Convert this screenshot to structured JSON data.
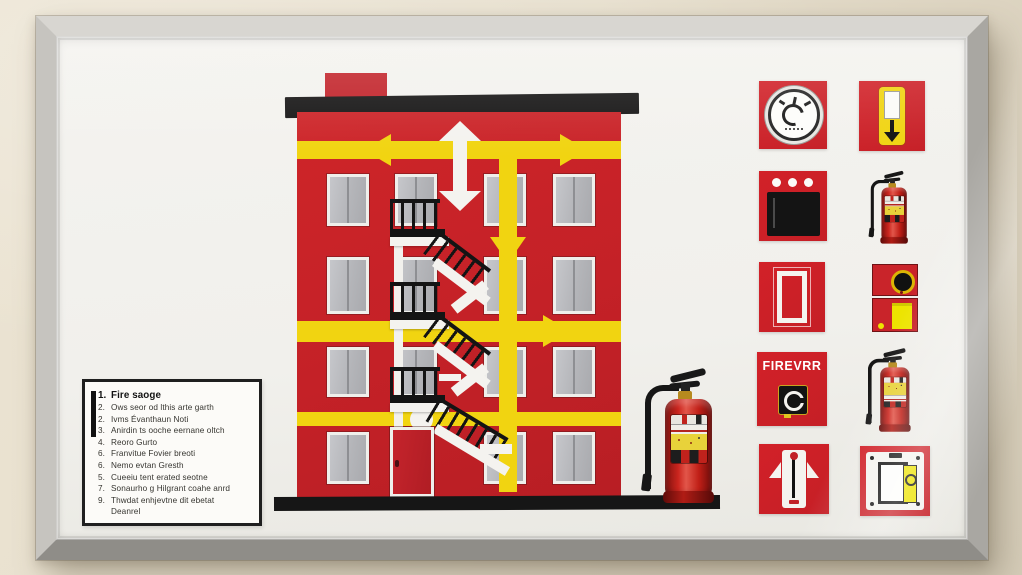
{
  "poster": {
    "description": "framed fire evacuation diagram poster",
    "legend": {
      "items": [
        {
          "num": "1.",
          "text": "Fire saoge"
        },
        {
          "num": "2.",
          "text": "Ows seor od lthis arte garth"
        },
        {
          "num": "2.",
          "text": "Ivms Évanthaun Noti"
        },
        {
          "num": "3.",
          "text": "Anirdin ts ooche eernane oltch"
        },
        {
          "num": "4.",
          "text": "Reoro Gurto"
        },
        {
          "num": "6.",
          "text": "Franvitue Fovier breoti"
        },
        {
          "num": "6.",
          "text": "Nemo evtan Gresth"
        },
        {
          "num": "5.",
          "text": "Cueeiu tent erated seotne"
        },
        {
          "num": "7.",
          "text": "Sonaurho g Hilgrant coahe anrd"
        },
        {
          "num": "9.",
          "text": "Thwdat enhjevtne dit ebetat"
        },
        {
          "num": "",
          "text": "Deanrel"
        }
      ]
    },
    "signs": {
      "firevrr_label": "FIREVRR",
      "tiles": [
        {
          "name": "alarm-bell-gauge-sign"
        },
        {
          "name": "evacuation-down-arrow-sign"
        },
        {
          "name": "fire-alarm-panel-sign"
        },
        {
          "name": "fire-extinguisher-photo"
        },
        {
          "name": "exit-door-outline-sign"
        },
        {
          "name": "fire-hose-cabinet-sign"
        },
        {
          "name": "fire-alarm-call-point-sign"
        },
        {
          "name": "fire-extinguisher-photo-2"
        },
        {
          "name": "standpipe-riser-sign"
        },
        {
          "name": "alarm-switch-panel-sign"
        }
      ]
    },
    "colors": {
      "building_red": "#c9242a",
      "arrow_yellow": "#f1d411",
      "roof_black": "#171616",
      "window_gray": "#b4b5b9",
      "sign_red": "#cf2027",
      "extinguisher_red": "#cb251e",
      "frame_silver": "#b9b7b2",
      "wall_beige": "#e6ddca"
    }
  }
}
